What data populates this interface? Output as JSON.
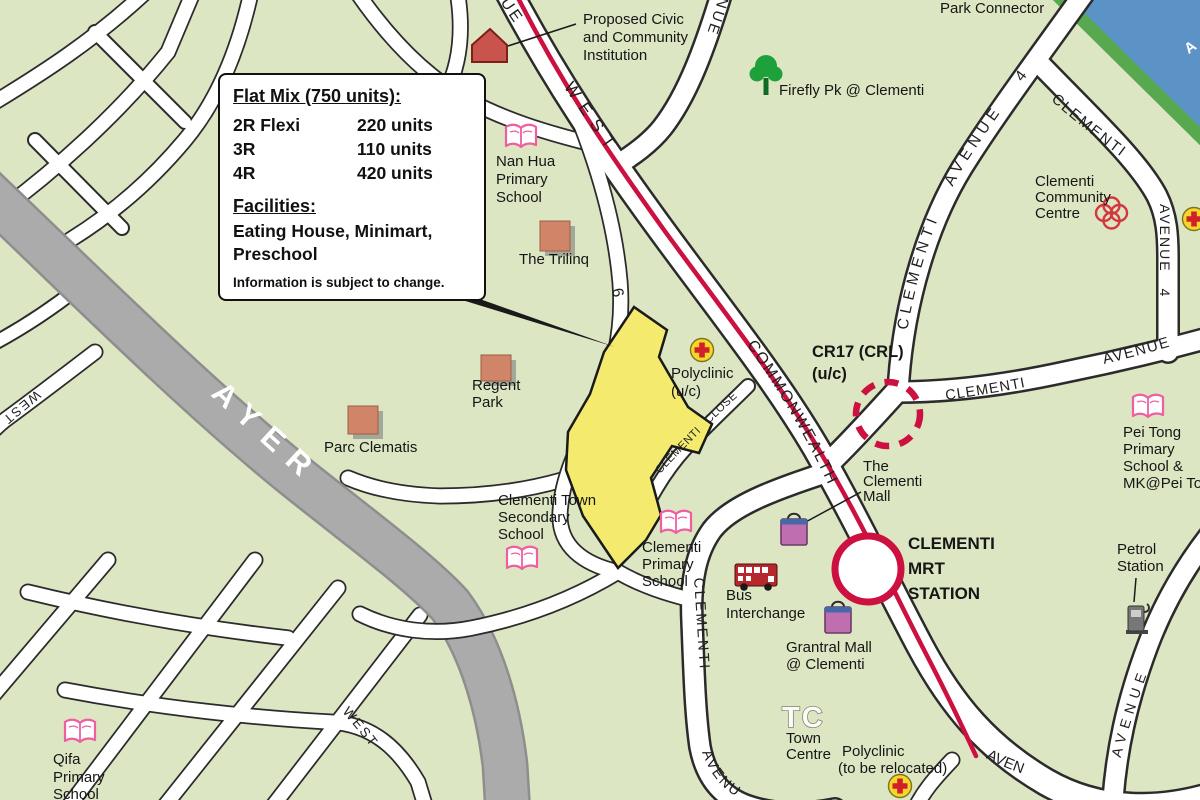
{
  "colors": {
    "background_green": "#dce6c3",
    "water_blue": "#5b93c7",
    "park_strip_green": "#57a84f",
    "road_white": "#ffffff",
    "expressway_gray": "#ababab",
    "mrt_line_red": "#cc1040",
    "site_yellow": "#f4eb6e",
    "building_salmon": "#d08468",
    "school_pink": "#ef5fa0",
    "mall_purple": "#bf6fb0",
    "bus_red": "#b5282c",
    "clinic_yellow": "#f5d62a",
    "cross_red": "#d1202a",
    "tree_green": "#1ea03b"
  },
  "infobox": {
    "title": "Flat Mix (750 units):",
    "rows": [
      {
        "type": "2R Flexi",
        "units": "220 units"
      },
      {
        "type": "3R",
        "units": "110 units"
      },
      {
        "type": "4R",
        "units": "420 units"
      }
    ],
    "facilities_title": "Facilities:",
    "facilities": "Eating House, Minimart, Preschool",
    "note": "Information is subject to change."
  },
  "pois": {
    "park_connector": [
      "Park Connector"
    ],
    "proposed_civic": [
      "Proposed Civic",
      "and Community",
      "Institution"
    ],
    "firefly_park": [
      "Firefly Pk @ Clementi"
    ],
    "nan_hua": [
      "Nan Hua",
      "Primary",
      "School"
    ],
    "community_centre": [
      "Clementi",
      "Community",
      "Centre"
    ],
    "trilinq": [
      "The Trilinq"
    ],
    "regent_park": [
      "Regent",
      "Park"
    ],
    "parc_clematis": [
      "Parc Clematis"
    ],
    "cr17": [
      "CR17 (CRL)",
      "(u/c)"
    ],
    "polyclinic_uc": [
      "Polyclinic",
      "(u/c)"
    ],
    "clementi_mall": [
      "The",
      "Clementi",
      "Mall"
    ],
    "mrt_station": [
      "CLEMENTI",
      "MRT",
      "STATION"
    ],
    "town_sec": [
      "Clementi Town",
      "Secondary",
      "School"
    ],
    "clementi_primary": [
      "Clementi",
      "Primary",
      "School"
    ],
    "bus_interchange": [
      "Bus",
      "Interchange"
    ],
    "grantral_mall": [
      "Grantral Mall",
      "@ Clementi"
    ],
    "tc": [
      "TC"
    ],
    "town_centre": [
      "Town",
      "Centre"
    ],
    "polyclinic_reloc": [
      "Polyclinic",
      "(to be relocated)"
    ],
    "pei_tong": [
      "Pei Tong",
      "Primary",
      "School &",
      "MK@Pei To"
    ],
    "petrol": [
      "Petrol",
      "Station"
    ],
    "qifa": [
      "Qifa",
      "Primary",
      "School"
    ]
  },
  "roads": {
    "ue": "UE",
    "west_top": "WEST",
    "commonwealth": "COMMONWEALTH",
    "aven_bottom": "AVEN",
    "nue": "NUE",
    "clementi_ave4": "CLEMENTI AVENUE 4",
    "clementi_diag": "CLEMENTI",
    "avenue4_vertical": "AVENUE 4",
    "clementi_east": "CLEMENTI",
    "avenue_east": "AVENUE",
    "clementi_close": "CLEMENTI CLOSE",
    "ave6_number": "6",
    "ayer": "AYER",
    "west_left": "WEST",
    "west_bottom": "WEST",
    "clementi_ave3_vertical": "CLEMENTI",
    "avenu_bottom": "AVENU",
    "avenue_right": "AVENUE",
    "water_text_fragment": "A"
  }
}
